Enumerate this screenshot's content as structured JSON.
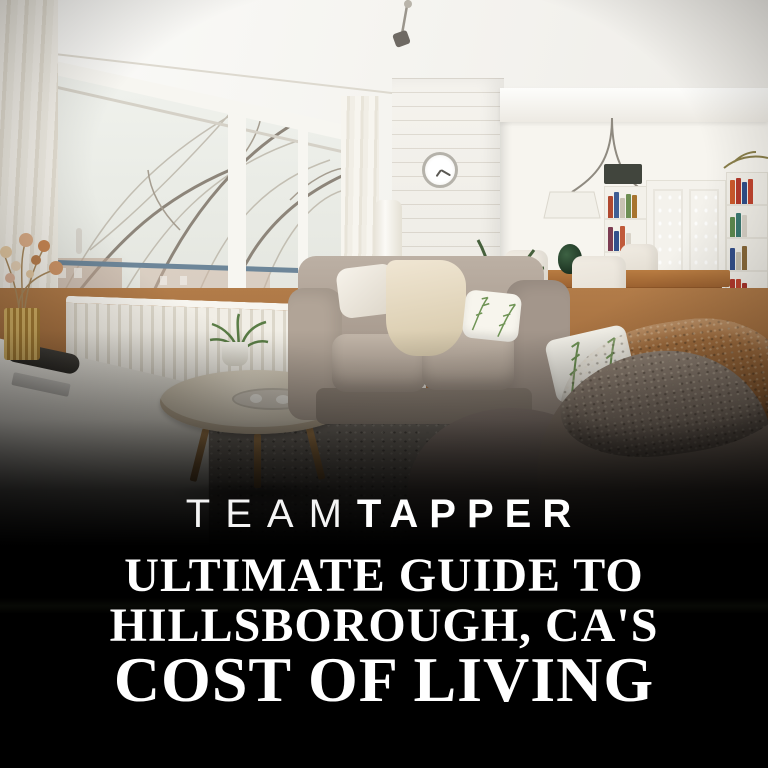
{
  "branding": {
    "team": "TEAM",
    "tapper": "TAPPER"
  },
  "title": {
    "line1": "ULTIMATE GUIDE TO",
    "line2": "HILLSBOROUGH, CA'S",
    "line3": "COST OF LIVING"
  },
  "photo": {
    "alt": "Bright living room: large window with bare trees, white radiator, taupe sofa with fern pillows and cream throw, round wooden coffee table on gray shag rug, dining nook with white hutch and bookshelves, fuzzy blanket on foreground sofa"
  },
  "colors": {
    "background": "#000000",
    "text": "#ffffff"
  }
}
